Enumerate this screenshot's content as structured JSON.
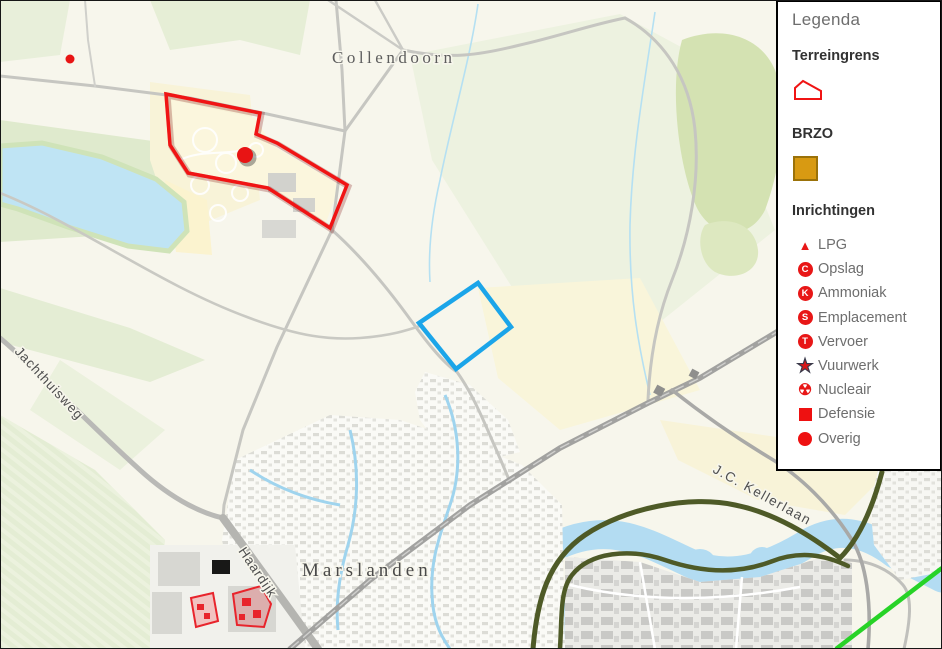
{
  "legend": {
    "title": "Legenda",
    "terreingrens": {
      "heading": "Terreingrens"
    },
    "brzo": {
      "heading": "BRZO"
    },
    "inrichtingen": {
      "heading": "Inrichtingen",
      "items": [
        {
          "icon": "lpg-triangle-icon",
          "glyph": "▲",
          "label": "LPG"
        },
        {
          "icon": "opslag-circle-icon",
          "letter": "C",
          "label": "Opslag"
        },
        {
          "icon": "ammoniak-circle-icon",
          "letter": "K",
          "label": "Ammoniak"
        },
        {
          "icon": "emplacement-circle-icon",
          "letter": "S",
          "label": "Emplacement"
        },
        {
          "icon": "vervoer-circle-icon",
          "letter": "T",
          "label": "Vervoer"
        },
        {
          "icon": "vuurwerk-star-icon",
          "glyph": "★",
          "label": "Vuurwerk"
        },
        {
          "icon": "nucleair-icon",
          "glyph": "☢",
          "label": "Nucleair"
        },
        {
          "icon": "defensie-square-icon",
          "label": "Defensie"
        },
        {
          "icon": "overig-circle-icon",
          "label": "Overig"
        }
      ]
    }
  },
  "map": {
    "place_labels": {
      "collendoorn": "Collendoorn",
      "marslanden": "Marslanden"
    },
    "road_labels": {
      "jachthuisweg": "Jachthuisweg",
      "haardijk": "Haardijk",
      "kellerlaan": "J.C. Kellerlaan"
    }
  },
  "colors": {
    "terreingrens_red": "#f01414",
    "selection_blue": "#1ba5e9",
    "brzo_orange": "#d89a12",
    "inrichting_red": "#e81717",
    "highlight_green": "#27d327",
    "water_blue": "#bfe4f4"
  }
}
